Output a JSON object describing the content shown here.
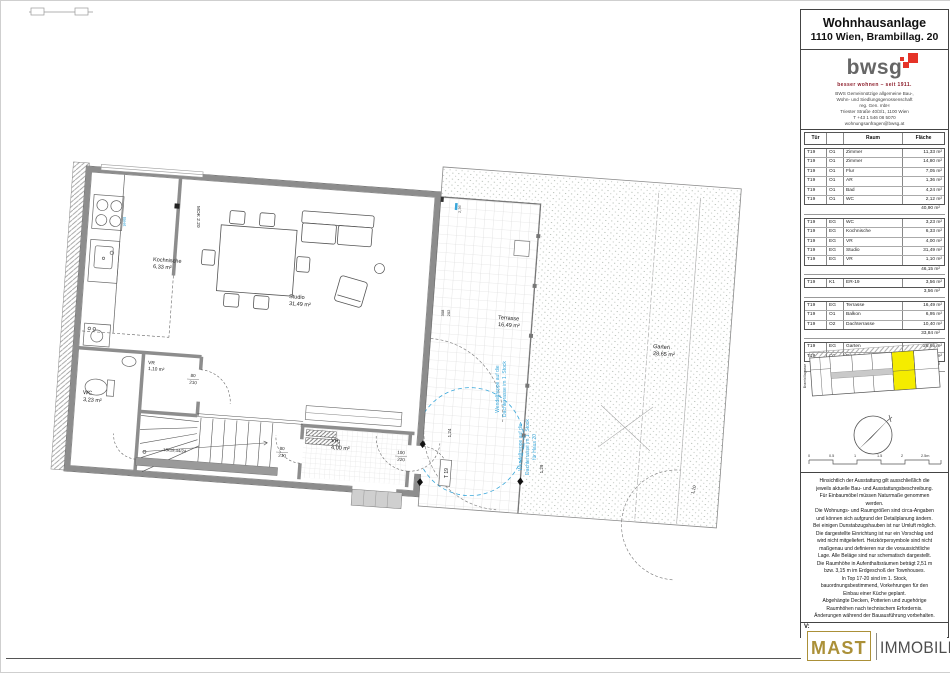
{
  "sheet": {
    "title_line1": "Wohnhausanlage",
    "title_line2": "1110 Wien, Brambillag. 20"
  },
  "brand": {
    "logo_word": "bwsg",
    "tagline": "besser wohnen – seit 1911.",
    "address": [
      "BWS Gemeinnützige allgemeine Bau-,",
      "Wohn- und Siedlungsgenossenschaft",
      "reg. Gen. mbH",
      "Triester Straße 40/3/1, 1100 Wien",
      "T +43 1 546 08 5070",
      "wohnungsanfragen@bwsg.at"
    ]
  },
  "room_table": {
    "headers": [
      "Tür",
      "",
      "Raum",
      "Fläche"
    ],
    "groups": [
      {
        "rows": [
          [
            "T19",
            "O1",
            "Zimmer",
            "11,33 m²"
          ],
          [
            "T19",
            "O1",
            "Zimmer",
            "14,80 m²"
          ],
          [
            "T19",
            "O1",
            "Flur",
            "7,05 m²"
          ],
          [
            "T19",
            "O1",
            "AR",
            "1,36 m²"
          ],
          [
            "T19",
            "O1",
            "Bad",
            "4,24 m²"
          ],
          [
            "T19",
            "O1",
            "WC",
            "2,12 m²"
          ]
        ],
        "subtotal": "40,90 m²"
      },
      {
        "rows": [
          [
            "T19",
            "EG",
            "WC",
            "3,23 m²"
          ],
          [
            "T19",
            "EG",
            "Kochnische",
            "6,33 m²"
          ],
          [
            "T19",
            "EG",
            "VR",
            "4,00 m²"
          ],
          [
            "T19",
            "EG",
            "Studio",
            "31,49 m²"
          ],
          [
            "T19",
            "EG",
            "VR",
            "1,10 m²"
          ]
        ],
        "subtotal": "46,15 m²"
      },
      {
        "rows": [
          [
            "T19",
            "K1",
            "ER-19",
            "3,56 m²"
          ]
        ],
        "subtotal": "3,56 m²"
      },
      {
        "rows": [
          [
            "T19",
            "EG",
            "Terrasse",
            "16,49 m²"
          ],
          [
            "T19",
            "O1",
            "Balkon",
            "6,95 m²"
          ],
          [
            "T19",
            "O2",
            "Dachterrasse",
            "10,40 m²"
          ]
        ],
        "subtotal": "33,84 m²"
      },
      {
        "rows": [
          [
            "T19",
            "EG",
            "Garten",
            "28,65 m²"
          ],
          [
            "T19",
            "O2",
            "Dachgarten",
            "28,78 m²"
          ]
        ],
        "subtotal": "57,43 m²"
      }
    ]
  },
  "site_plan": {
    "street": "Brambillagasse"
  },
  "scale_bar": {
    "labels": [
      "0",
      "0.5",
      "1",
      "1.5",
      "2",
      "2.5m"
    ]
  },
  "disclaimer_lines": [
    "Hinsichtlich der Ausstattung gilt ausschließlich die",
    "jeweils aktuelle Bau- und Ausstattungsbeschreibung.",
    "Für Einbaumöbel müssen Naturmaße genommen",
    "werden.",
    "Die Wohnungs- und Raumgrößen sind circa-Angaben",
    "und können sich aufgrund der Detailplanung ändern.",
    "Bei einigen Dunstabzugshauben ist nur Umluft möglich.",
    "Die dargestellte Einrichtung ist nur ein Vorschlag und",
    "wird nicht mitgeliefert. Heizkörpersymbole sind nicht",
    "maßgenau und definieren nur die voraussichtliche",
    "Lage. Alle Beläge sind nur schematisch dargestellt.",
    "Die Raumhöhe in Aufenthaltsräumen beträgt 2,51 m",
    "bzw. 3,15 m im Erdgeschoß der Townhouses.",
    "In Top 17-20 sind im 1. Stock,",
    "bauordnungsbestimmend, Vorkehrungen für den",
    "Einbau einer Küche geplant.",
    "Abgehängte Decken, Potterien und zugehörige",
    "Raumhöhen nach technischem Erfordernis.",
    "Änderungen während der Bauausführung vorbehalten."
  ],
  "version": {
    "label": "V:",
    "value": "19"
  },
  "footer_logo": {
    "word1": "MAST",
    "word2": "IMMOBILIEN"
  },
  "plan": {
    "rooms": {
      "kochnische": {
        "name": "Kochnische",
        "area": "6,33 m²"
      },
      "studio": {
        "name": "Studio",
        "area": "31,49 m²"
      },
      "wc": {
        "name": "WC",
        "area": "3,23 m²"
      },
      "vr_small": {
        "name": "VR",
        "area": "1,10 m²"
      },
      "vr": {
        "name": "VR",
        "area": "4,00 m²"
      },
      "terrasse": {
        "name": "Terrasse",
        "area": "16,49 m²"
      },
      "garten": {
        "name": "Garten",
        "area": "28,65 m²"
      }
    },
    "dims": {
      "d80": "80",
      "d210": "210",
      "d100": "100",
      "d220": "220",
      "w308": "308",
      "w202": "202",
      "l124": "1,24",
      "l129": "1,29",
      "l110": "1,10",
      "l236": "2,36",
      "mok": "MOK 2.20",
      "stairs": "18x19,44/24",
      "door_tag": "T 19"
    },
    "annotations": {
      "wendeltreppe_l1": "Wendeltreppe auf die",
      "wendeltreppe_l2": "Dachterrasse im 1. Stock",
      "wendeltreppe_l3": "für Haus 20",
      "beet": "Beet"
    }
  },
  "colors": {
    "highlight_yellow": "#f5ec00",
    "revision_blue": "#3aa7da",
    "brand_red": "#e53328",
    "logo_gold": "#ab9038"
  }
}
